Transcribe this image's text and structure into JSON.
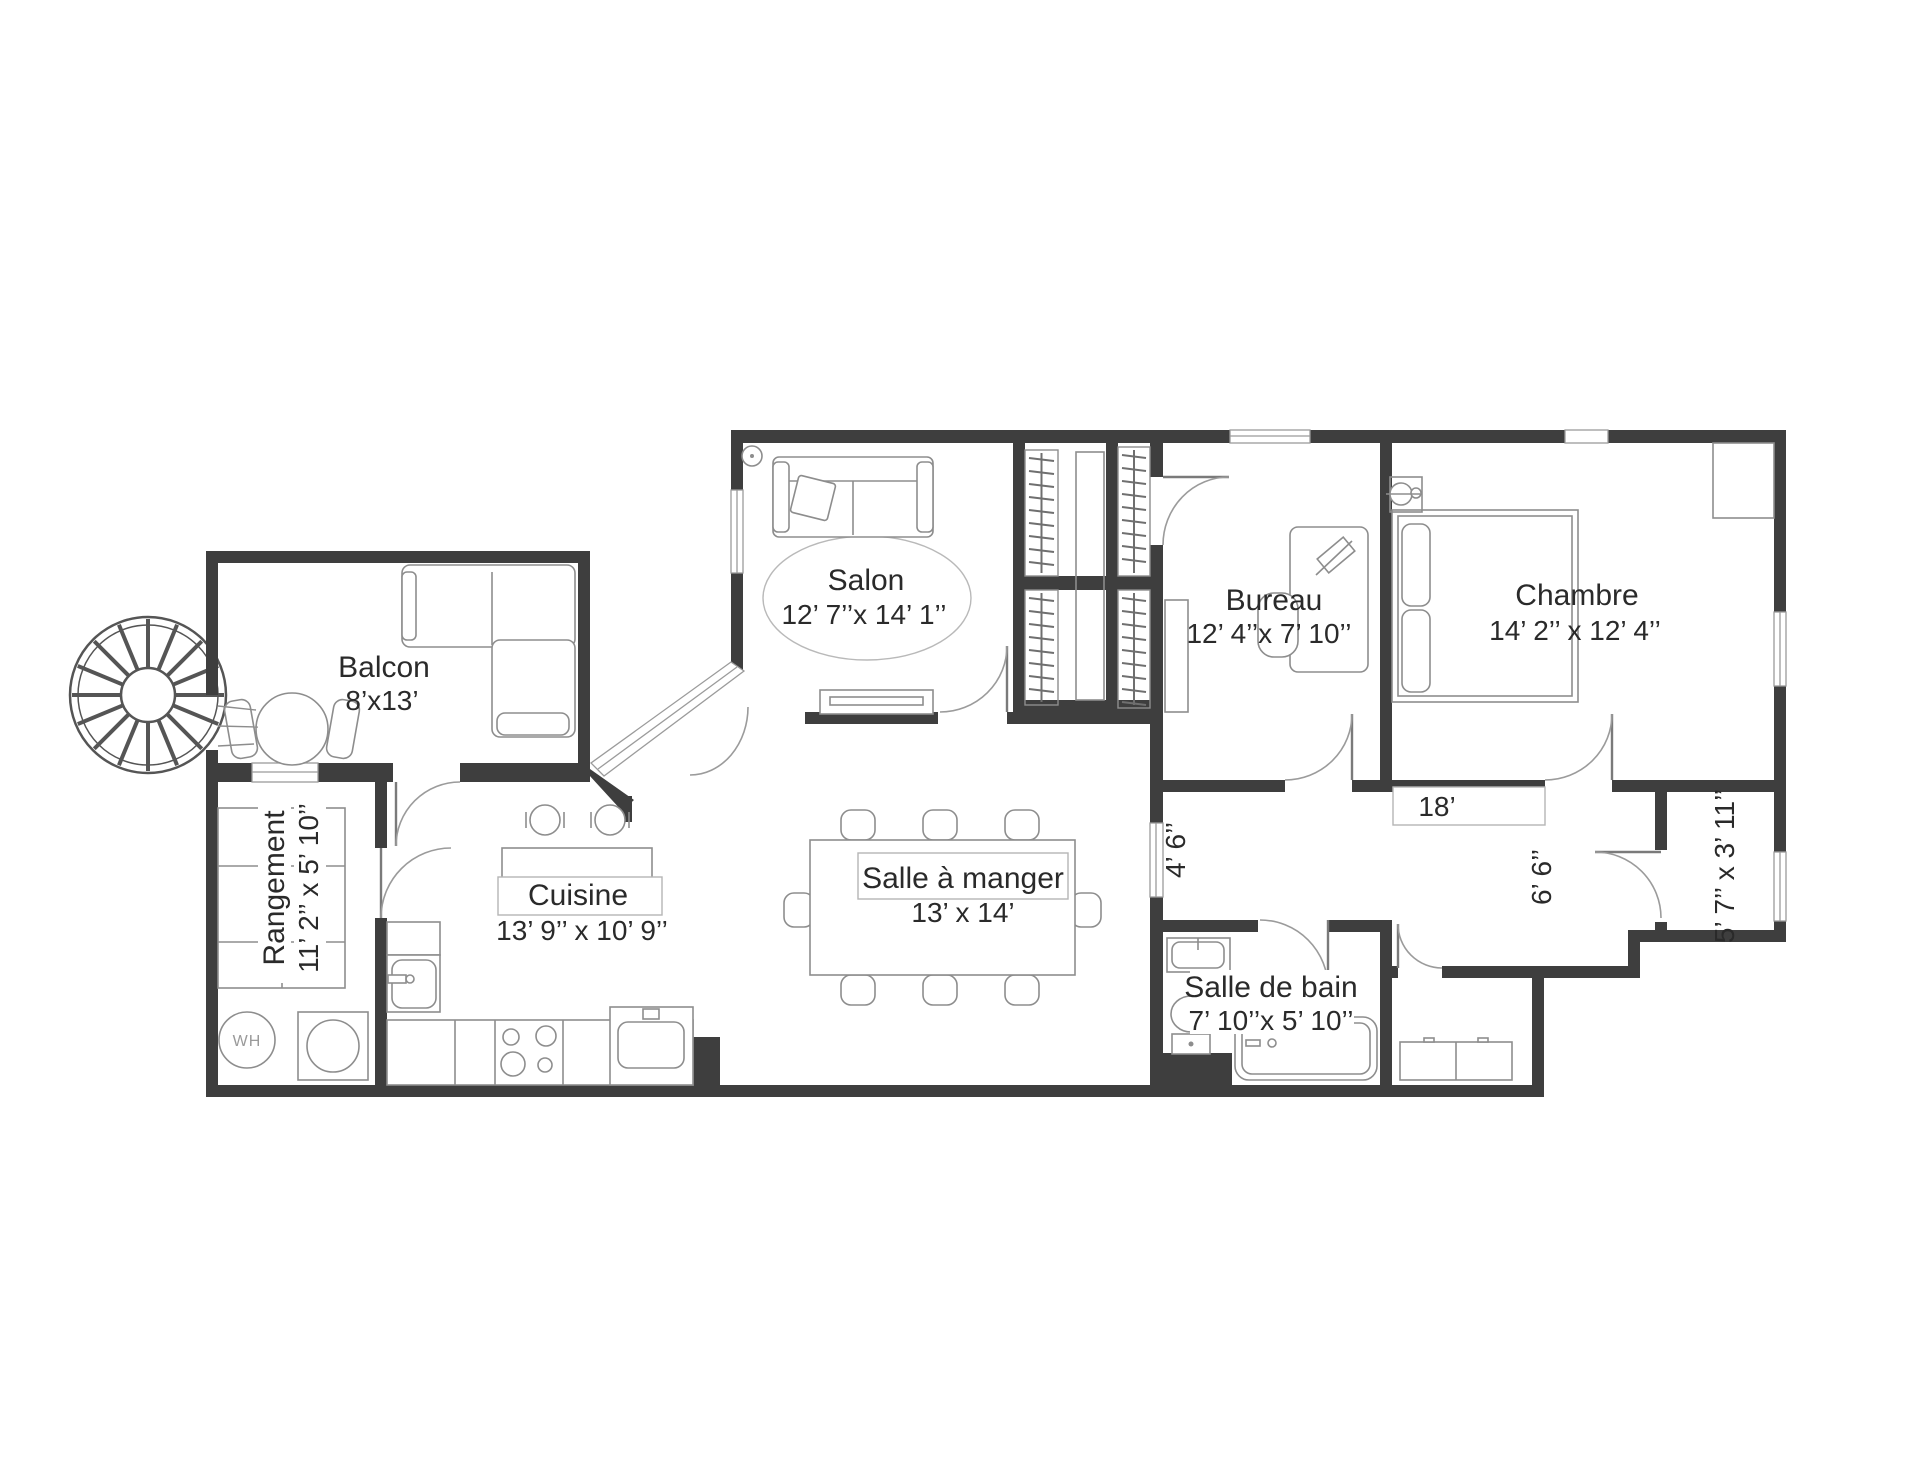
{
  "plan": {
    "rooms": {
      "balcon": {
        "name": "Balcon",
        "dims": "8’x13’"
      },
      "salon": {
        "name": "Salon",
        "dims": "12’ 7’’x 14’ 1’’"
      },
      "bureau": {
        "name": "Bureau",
        "dims": "12’ 4’’x 7’ 10’’"
      },
      "chambre": {
        "name": "Chambre",
        "dims": "14’ 2’’ x 12’ 4’’"
      },
      "rangement": {
        "name": "Rangement",
        "dims": "11’ 2’’ x 5’ 10’’"
      },
      "cuisine": {
        "name": "Cuisine",
        "dims": "13’ 9’’ x 10’ 9’’"
      },
      "salle_a_manger": {
        "name": "Salle à manger",
        "dims": "13’ x 14’"
      },
      "salle_de_bain": {
        "name": "Salle de bain",
        "dims": "7’ 10’’x 5’ 10’’"
      }
    },
    "measurements": {
      "hall_width_left": "4’ 6’’",
      "hall_length": "18’",
      "hall_width_right": "6’ 6’’",
      "entry_closet": "5’ 7’’ x 3’ 11’’"
    },
    "appliances": {
      "water_heater": "WH"
    },
    "colors": {
      "wall": "#3e3e3e",
      "furniture_line": "#8d8d8d",
      "text": "#2a2a2a"
    }
  }
}
